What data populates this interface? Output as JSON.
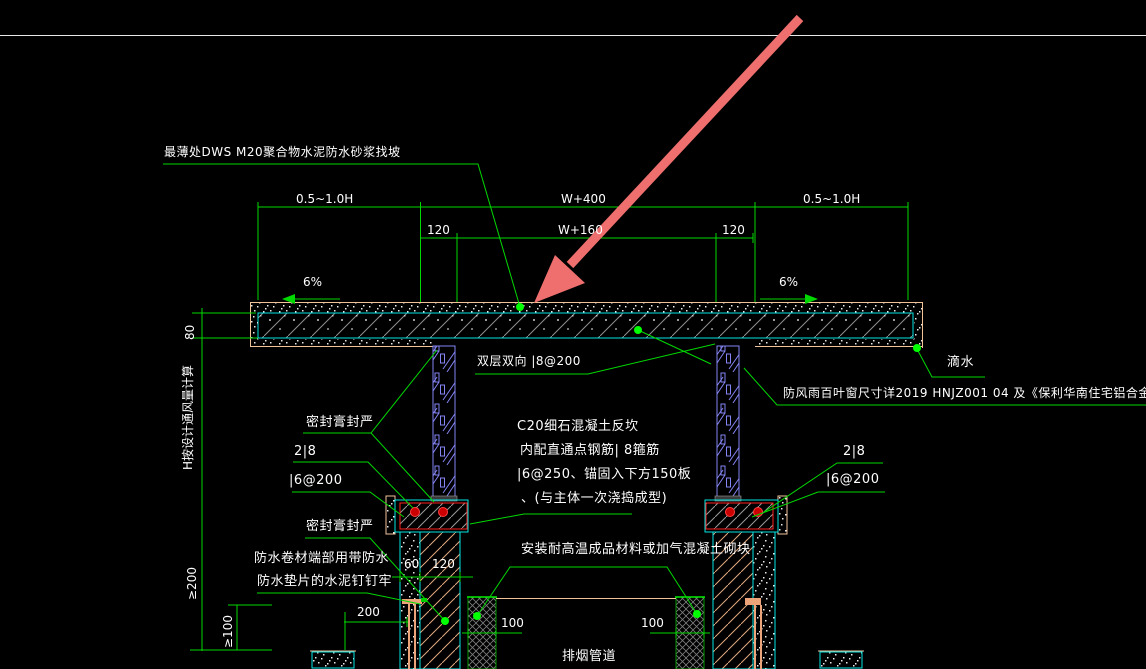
{
  "annotations": {
    "screed_note": "最薄处DWS M20聚合物水泥防水砂浆找坡",
    "slab_rebar_note": "双层双向 |8@200",
    "sealant_top": "密封膏封严",
    "sealant_bottom": "密封膏封严",
    "rebar_2d8_left": "2|8",
    "stirrup_left": "|6@200",
    "rebar_2d8_right": "2|8",
    "stirrup_right": "|6@200",
    "curb_line1": "C20细石混凝土反坎",
    "curb_line2": "内配直通点钢筋| 8箍筋",
    "curb_line3": "|6@250、锚固入下方150板",
    "curb_line4": "、(与主体一次浇捣成型)",
    "membrane_line1": "防水卷材端部用带防水",
    "membrane_line2": "防水垫片的水泥钉钉牢",
    "block_note": "安装耐高温成品材料或加气混凝土砌块",
    "duct_label": "排烟管道",
    "louver_note": "防风雨百叶窗尺寸详2019 HNJZ001 04 及《保利华南住宅铝合金门窗标",
    "drip_label": "滴水",
    "height_note": "H按设计通风量计算",
    "slope_left": "6%",
    "slope_right": "6%"
  },
  "dimensions": {
    "top_left": "0.5~1.0H",
    "top_mid": "W+400",
    "top_right": "0.5~1.0H",
    "second_left": "120",
    "second_mid": "W+160",
    "second_right": "120",
    "slab_thickness": "80",
    "wall_60": "60",
    "wall_120": "120",
    "bottom_200": "200",
    "min_200": "≥200",
    "min_100": "≥100",
    "duct_100_left": "100",
    "duct_100_right": "100"
  },
  "colors": {
    "background": "#000000",
    "line_green": "#00d900",
    "dot_green": "#00ff00",
    "text_white": "#ffffff",
    "cyan": "#00e5e5",
    "tan": "#f2c49a",
    "blue_frame": "#8585f5",
    "red": "#ff2020",
    "arrow_red": "#ef6f6f",
    "hatch_gray": "#909090"
  }
}
